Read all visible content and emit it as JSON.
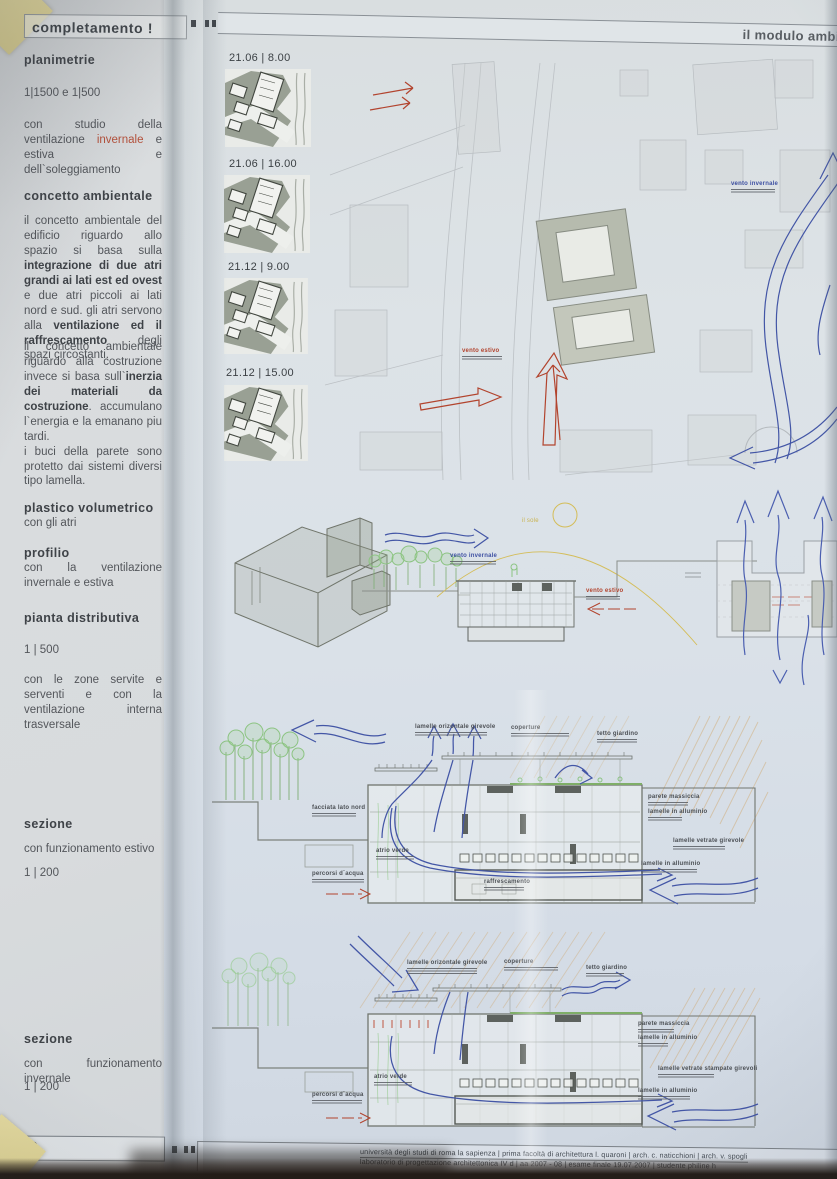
{
  "board": {
    "tab": "completamento !",
    "title": "il modulo ambien",
    "page": "06"
  },
  "sidebar": {
    "s1_heading": "planimetrie",
    "s1_scale": "1|1500  e  1|500",
    "s1p_a": "con studio della ventilazione ",
    "s1p_b": "invernale",
    "s1p_c": " e estiva e dell`soleggiamento",
    "s2_heading": "concetto ambientale",
    "p1_a": "il concetto ambientale del edificio riguardo allo spazio si basa sulla ",
    "p1_b": "integrazione di due atri grandi ai lati est ed ovest",
    "p1_c": " e due atri piccoli ai lati nord e sud. gli atri servono alla ",
    "p1_d": "ventilazione ed il raffrescamento",
    "p1_e": " degli spazi circostanti.",
    "p2_a": "il concetto ambientale riguardo alla costruzione invece si basa sull`",
    "p2_b": "inerzia dei materiali da costruzione",
    "p2_c": ". accumulano l`energia e la emanano piu tardi.",
    "p2_d": "i buci della parete sono protetto dai sistemi diversi tipo lamella.",
    "s3_heading": "plastico volumetrico",
    "s3_sub": "con gli atri",
    "s4_heading": "profilio",
    "s4_sub": "con la ventilazione invernale e estiva",
    "s5_heading": "pianta distributiva",
    "s5_scale": "1 | 500",
    "s5_sub": "con le zone servite e serventi e con la ventilazione interna trasversale",
    "s6_heading": "sezione",
    "s6_sub": "con funzionamento estivo",
    "s6_scale": "1 | 200",
    "s7_heading": "sezione",
    "s7_sub": "con funzionamento invernale",
    "s7_scale": "1 | 200"
  },
  "thumbs": {
    "t1": "21.06 | 8.00",
    "t2": "21.06 | 16.00",
    "t3": "21.12 | 9.00",
    "t4": "21.12 | 15.00"
  },
  "plan": {
    "summer": "vento estivo",
    "winter": "vento invernale"
  },
  "profile": {
    "sun": "il sole",
    "winter": "vento invernale",
    "summer": "vento estivo"
  },
  "sec1": {
    "top1": "lamelle orizontale girevole",
    "top2": "coperture",
    "top3": "tetto giardino",
    "l1": "facciata lato nord",
    "l2": "atrio verde",
    "l3": "percorsi d`acqua",
    "mid": "raffrescamento",
    "r1": "parete massiccia",
    "r2": "lamelle in alluminio",
    "r3": "lamelle vetrate girevole",
    "r4": "lamelle in alluminio"
  },
  "sec2": {
    "top1": "lamelle orizontale girevole",
    "top2": "coperture",
    "top3": "tetto giardino",
    "l2": "atrio verde",
    "l3": "percorsi d`acqua",
    "r1": "parete massiccia",
    "r2": "lamelle in alluminio",
    "r3": "lamelle vetrate stampate girevoli",
    "r4": "lamelle in alluminio"
  },
  "footer": {
    "line1": "università degli studi di roma la sapienza | prima facoltà di architettura l. quaroni | arch. c. naticchioni | arch. v. spogli",
    "line2": "laboratorio di progettazione architettonica IV d | aa 2007 - 08 | esame finale 19.07.2007 | studente philine h"
  },
  "colors": {
    "accent_red": "#b2442e",
    "accent_blue": "#4356a6",
    "green": "#8cc482",
    "sun": "#d4bd58"
  }
}
